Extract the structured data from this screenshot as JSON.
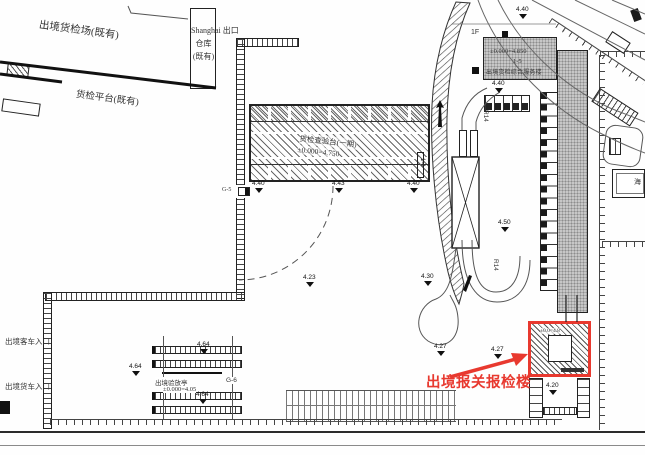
{
  "annotation": {
    "building_label": "出境报关报检楼"
  },
  "existing_area": {
    "yard_label": "出境货检场(既有)",
    "warehouse": {
      "l1": "出口",
      "l2": "仓库",
      "l3": "(既有)"
    },
    "platform_label": "货检平台(既有)"
  },
  "entrances": {
    "passenger": "出境客车入口",
    "cargo": "出境货车入口"
  },
  "inspection_platform": {
    "name": "货检查验台(一期)",
    "elevation": "±0.000=4.750"
  },
  "service_building": {
    "floor": "1F",
    "elevation": "±0.000=4.850",
    "code": "1-5",
    "name": "出境货检综合服务楼"
  },
  "checkpoint_booth": {
    "name": "出境验放亭",
    "ref": "G-6",
    "elevation": "±0.000=4.05"
  },
  "customs_box": {
    "elevation": "±0.0=4.8"
  },
  "gate_label": "G-5",
  "radius_labels": {
    "top": "R14",
    "bottom": "R14"
  },
  "ramp_label": "1-4",
  "right_room_label": "海",
  "colors": {
    "annotation_red": "#e8392f",
    "line_dark": "#222222",
    "building_gray": "#c7c7c7"
  },
  "spot_elevations": [
    {
      "value": "4.40"
    },
    {
      "value": "4.43"
    },
    {
      "value": "4.40"
    },
    {
      "value": "4.40"
    },
    {
      "value": "4.40"
    },
    {
      "value": "4.50"
    },
    {
      "value": "4.23"
    },
    {
      "value": "4.30"
    },
    {
      "value": "4.64"
    },
    {
      "value": "4.64"
    },
    {
      "value": "4.64"
    },
    {
      "value": "4.27"
    },
    {
      "value": "4.27"
    },
    {
      "value": "4.20"
    }
  ]
}
